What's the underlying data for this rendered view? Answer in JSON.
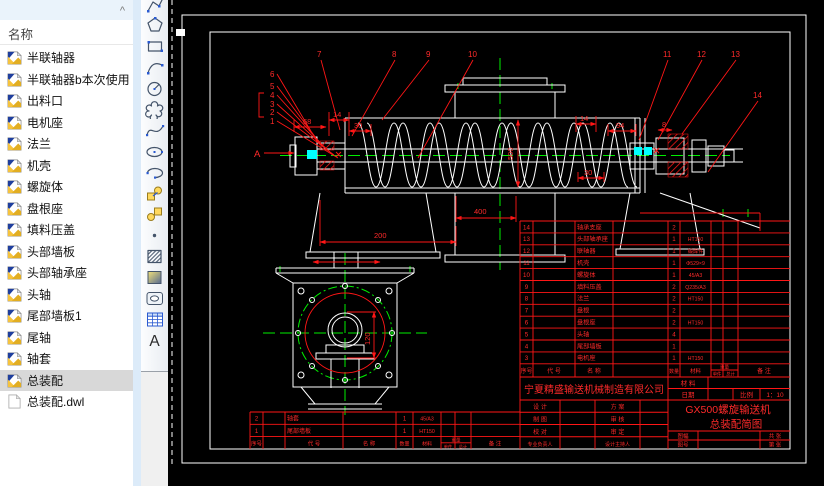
{
  "file_panel": {
    "header_label": "名称",
    "collapse_glyph": "^",
    "selected_item": "总装配",
    "items": [
      {
        "label": "半联轴器",
        "type": "dwg"
      },
      {
        "label": "半联轴器b本次使用",
        "type": "dwg"
      },
      {
        "label": "出料口",
        "type": "dwg"
      },
      {
        "label": "电机座",
        "type": "dwg"
      },
      {
        "label": "法兰",
        "type": "dwg"
      },
      {
        "label": "机壳",
        "type": "dwg"
      },
      {
        "label": "螺旋体",
        "type": "dwg"
      },
      {
        "label": "盘根座",
        "type": "dwg"
      },
      {
        "label": "填料压盖",
        "type": "dwg"
      },
      {
        "label": "头部墙板",
        "type": "dwg"
      },
      {
        "label": "头部轴承座",
        "type": "dwg"
      },
      {
        "label": "头轴",
        "type": "dwg"
      },
      {
        "label": "尾部墙板1",
        "type": "dwg"
      },
      {
        "label": "尾轴",
        "type": "dwg"
      },
      {
        "label": "轴套",
        "type": "dwg"
      },
      {
        "label": "总装配",
        "type": "dwg"
      },
      {
        "label": "总装配.dwl",
        "type": "dwl"
      }
    ]
  },
  "toolbar": {
    "tools": [
      "polyline",
      "polygon",
      "rectangle",
      "arc",
      "circle",
      "revision-cloud",
      "spline",
      "ellipse",
      "ellipse-arc",
      "insert-block",
      "make-block",
      "point",
      "hatch",
      "gradient",
      "region",
      "table",
      "multiline-text"
    ]
  },
  "drawing": {
    "colors": {
      "background": "#000000",
      "geometry": "#ffffff",
      "annotation": "#ff1616",
      "centerline": "#00ee00",
      "seal": "#00ffff"
    },
    "section_label": "A",
    "callouts": [
      "1",
      "2",
      "3",
      "4",
      "5",
      "6",
      "7",
      "8",
      "9",
      "10",
      "11",
      "12",
      "13",
      "14"
    ],
    "dimensions": {
      "d68": "68",
      "d14_left": "14",
      "d30_left": "30",
      "d200": "200",
      "d400": "400",
      "d500": "500",
      "d14_right": "14",
      "d94": "94",
      "d8": "8",
      "d30_right": "30",
      "d120": "120"
    },
    "title_block": {
      "company": "宁夏精盛输送机械制造有限公司",
      "product": "GX500螺旋输送机",
      "drawing_title": "总装配简图",
      "material_label": "材 料",
      "date_label": "日期",
      "scale_label": "比例",
      "scale_value": "1：10",
      "design_label": "设 计",
      "draft_label": "制 图",
      "check_label": "校 对",
      "lead_label": "专业负责人",
      "scheme_label": "方 案",
      "review_label": "审 核",
      "approve_label": "审 定",
      "host_label": "设计主持人",
      "sheet_size_label": "图幅",
      "sheet_no_label": "图号",
      "total_sheets_label": "共 张",
      "page_label": "第 张",
      "bom_headers": {
        "no": "序号",
        "code": "代 号",
        "name": "名 称",
        "qty": "数量",
        "material": "材料",
        "weight": "重量",
        "unit": "单件",
        "total": "总计",
        "remark": "备 注"
      },
      "bom_rows": [
        {
          "no": "14",
          "name": "轴承支座",
          "qty": "2",
          "mat": ""
        },
        {
          "no": "13",
          "name": "头部轴承座",
          "qty": "1",
          "mat": "HT150"
        },
        {
          "no": "12",
          "name": "联轴器",
          "qty": "1",
          "mat": "锻焊件"
        },
        {
          "no": "11",
          "name": "机壳",
          "qty": "1",
          "mat": "Φ529×9"
        },
        {
          "no": "10",
          "name": "螺旋体",
          "qty": "1",
          "mat": "45/A3"
        },
        {
          "no": "9",
          "name": "填料压盖",
          "qty": "2",
          "mat": "Q235/A3"
        },
        {
          "no": "8",
          "name": "法兰",
          "qty": "2",
          "mat": "HT150"
        },
        {
          "no": "7",
          "name": "盘根",
          "qty": "2",
          "mat": ""
        },
        {
          "no": "6",
          "name": "盘根座",
          "qty": "2",
          "mat": "HT150"
        },
        {
          "no": "5",
          "name": "头轴",
          "qty": "4",
          "mat": ""
        },
        {
          "no": "4",
          "name": "尾部墙板",
          "qty": "1",
          "mat": ""
        },
        {
          "no": "3",
          "name": "电机座",
          "qty": "1",
          "mat": "HT150"
        }
      ],
      "bom2_rows": [
        {
          "no": "2",
          "name": "轴套",
          "qty": "1",
          "mat": "45/A3"
        },
        {
          "no": "1",
          "name": "尾部墙板",
          "qty": "1",
          "mat": "HT150"
        }
      ]
    }
  }
}
